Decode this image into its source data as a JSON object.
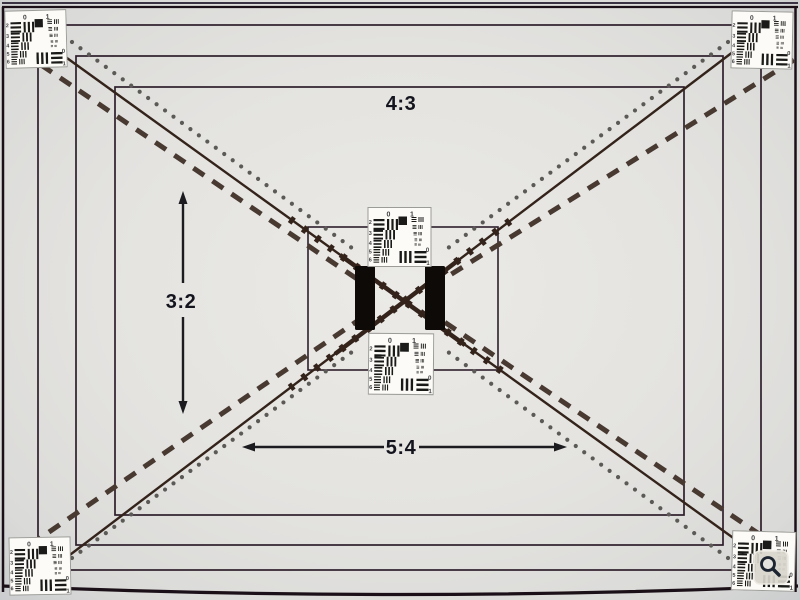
{
  "labels": {
    "aspect_4_3": "4:3",
    "aspect_3_2": "3:2",
    "aspect_5_4": "5:4"
  },
  "usaf_target": {
    "top_labels": [
      "0",
      "1"
    ],
    "row_labels": [
      "2",
      "3",
      "4",
      "5",
      "6"
    ],
    "corner_labels": [
      "0",
      "1"
    ]
  },
  "icons": {
    "magnifier": "magnifier-icon"
  },
  "colors": {
    "background_center": "#ebeae6",
    "background_mid": "#e4e3e0",
    "background_corner": "#c6c9cb",
    "frame_line": "#2e1f2b",
    "outer_edge": "#1c1018",
    "diagonal_solid": "#33231a",
    "diagonal_dashed": "#483931",
    "diagonal_dotted": "#5c5a56",
    "center_bars": "#0d0a08",
    "label_ink": "#14141e",
    "card_bg": "#fcfbf7",
    "card_border": "#9b9b97"
  }
}
